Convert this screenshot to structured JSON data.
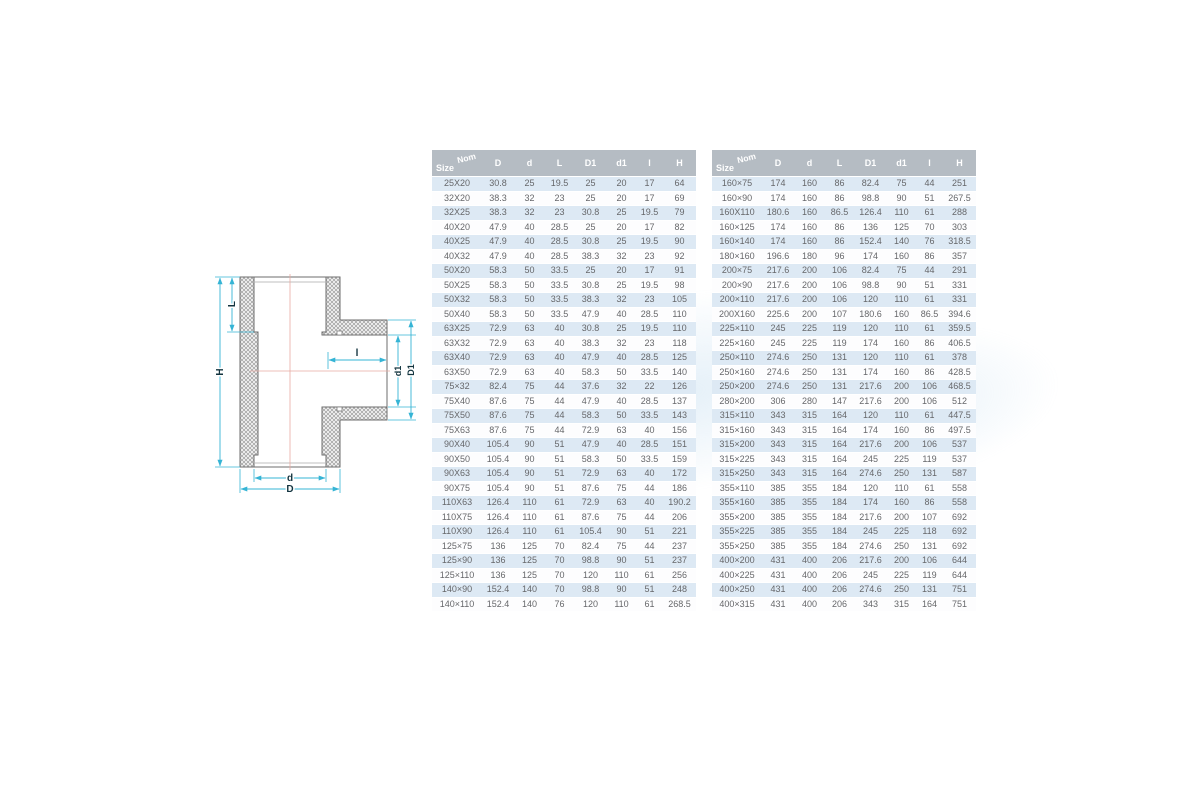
{
  "diagram": {
    "labels": {
      "H": "H",
      "L": "L",
      "l": "l",
      "d1": "d1",
      "D1": "D1",
      "d": "d",
      "D": "D"
    },
    "colors": {
      "dimension": "#35b4d5",
      "centerline": "#e8aaa2",
      "outline": "#6e6e6e",
      "hatch": "#8c8c8c",
      "label": "#13343f"
    }
  },
  "tables": {
    "corner": {
      "top": "Nom",
      "bottom": "Size"
    },
    "columns": [
      "D",
      "d",
      "L",
      "D1",
      "d1",
      "l",
      "H"
    ],
    "colors": {
      "header_bg": "#b5bcc3",
      "header_text": "#ffffff",
      "stripe": "#dde9f4",
      "row_text": "#66676a"
    },
    "left_rows": [
      [
        "25X20",
        "30.8",
        "25",
        "19.5",
        "25",
        "20",
        "17",
        "64"
      ],
      [
        "32X20",
        "38.3",
        "32",
        "23",
        "25",
        "20",
        "17",
        "69"
      ],
      [
        "32X25",
        "38.3",
        "32",
        "23",
        "30.8",
        "25",
        "19.5",
        "79"
      ],
      [
        "40X20",
        "47.9",
        "40",
        "28.5",
        "25",
        "20",
        "17",
        "82"
      ],
      [
        "40X25",
        "47.9",
        "40",
        "28.5",
        "30.8",
        "25",
        "19.5",
        "90"
      ],
      [
        "40X32",
        "47.9",
        "40",
        "28.5",
        "38.3",
        "32",
        "23",
        "92"
      ],
      [
        "50X20",
        "58.3",
        "50",
        "33.5",
        "25",
        "20",
        "17",
        "91"
      ],
      [
        "50X25",
        "58.3",
        "50",
        "33.5",
        "30.8",
        "25",
        "19.5",
        "98"
      ],
      [
        "50X32",
        "58.3",
        "50",
        "33.5",
        "38.3",
        "32",
        "23",
        "105"
      ],
      [
        "50X40",
        "58.3",
        "50",
        "33.5",
        "47.9",
        "40",
        "28.5",
        "110"
      ],
      [
        "63X25",
        "72.9",
        "63",
        "40",
        "30.8",
        "25",
        "19.5",
        "110"
      ],
      [
        "63X32",
        "72.9",
        "63",
        "40",
        "38.3",
        "32",
        "23",
        "118"
      ],
      [
        "63X40",
        "72.9",
        "63",
        "40",
        "47.9",
        "40",
        "28.5",
        "125"
      ],
      [
        "63X50",
        "72.9",
        "63",
        "40",
        "58.3",
        "50",
        "33.5",
        "140"
      ],
      [
        "75×32",
        "82.4",
        "75",
        "44",
        "37.6",
        "32",
        "22",
        "126"
      ],
      [
        "75X40",
        "87.6",
        "75",
        "44",
        "47.9",
        "40",
        "28.5",
        "137"
      ],
      [
        "75X50",
        "87.6",
        "75",
        "44",
        "58.3",
        "50",
        "33.5",
        "143"
      ],
      [
        "75X63",
        "87.6",
        "75",
        "44",
        "72.9",
        "63",
        "40",
        "156"
      ],
      [
        "90X40",
        "105.4",
        "90",
        "51",
        "47.9",
        "40",
        "28.5",
        "151"
      ],
      [
        "90X50",
        "105.4",
        "90",
        "51",
        "58.3",
        "50",
        "33.5",
        "159"
      ],
      [
        "90X63",
        "105.4",
        "90",
        "51",
        "72.9",
        "63",
        "40",
        "172"
      ],
      [
        "90X75",
        "105.4",
        "90",
        "51",
        "87.6",
        "75",
        "44",
        "186"
      ],
      [
        "110X63",
        "126.4",
        "110",
        "61",
        "72.9",
        "63",
        "40",
        "190.2"
      ],
      [
        "110X75",
        "126.4",
        "110",
        "61",
        "87.6",
        "75",
        "44",
        "206"
      ],
      [
        "110X90",
        "126.4",
        "110",
        "61",
        "105.4",
        "90",
        "51",
        "221"
      ],
      [
        "125×75",
        "136",
        "125",
        "70",
        "82.4",
        "75",
        "44",
        "237"
      ],
      [
        "125×90",
        "136",
        "125",
        "70",
        "98.8",
        "90",
        "51",
        "237"
      ],
      [
        "125×110",
        "136",
        "125",
        "70",
        "120",
        "110",
        "61",
        "256"
      ],
      [
        "140×90",
        "152.4",
        "140",
        "70",
        "98.8",
        "90",
        "51",
        "248"
      ],
      [
        "140×110",
        "152.4",
        "140",
        "76",
        "120",
        "110",
        "61",
        "268.5"
      ]
    ],
    "right_rows": [
      [
        "160×75",
        "174",
        "160",
        "86",
        "82.4",
        "75",
        "44",
        "251"
      ],
      [
        "160×90",
        "174",
        "160",
        "86",
        "98.8",
        "90",
        "51",
        "267.5"
      ],
      [
        "160X110",
        "180.6",
        "160",
        "86.5",
        "126.4",
        "110",
        "61",
        "288"
      ],
      [
        "160×125",
        "174",
        "160",
        "86",
        "136",
        "125",
        "70",
        "303"
      ],
      [
        "160×140",
        "174",
        "160",
        "86",
        "152.4",
        "140",
        "76",
        "318.5"
      ],
      [
        "180×160",
        "196.6",
        "180",
        "96",
        "174",
        "160",
        "86",
        "357"
      ],
      [
        "200×75",
        "217.6",
        "200",
        "106",
        "82.4",
        "75",
        "44",
        "291"
      ],
      [
        "200×90",
        "217.6",
        "200",
        "106",
        "98.8",
        "90",
        "51",
        "331"
      ],
      [
        "200×110",
        "217.6",
        "200",
        "106",
        "120",
        "110",
        "61",
        "331"
      ],
      [
        "200X160",
        "225.6",
        "200",
        "107",
        "180.6",
        "160",
        "86.5",
        "394.6"
      ],
      [
        "225×110",
        "245",
        "225",
        "119",
        "120",
        "110",
        "61",
        "359.5"
      ],
      [
        "225×160",
        "245",
        "225",
        "119",
        "174",
        "160",
        "86",
        "406.5"
      ],
      [
        "250×110",
        "274.6",
        "250",
        "131",
        "120",
        "110",
        "61",
        "378"
      ],
      [
        "250×160",
        "274.6",
        "250",
        "131",
        "174",
        "160",
        "86",
        "428.5"
      ],
      [
        "250×200",
        "274.6",
        "250",
        "131",
        "217.6",
        "200",
        "106",
        "468.5"
      ],
      [
        "280×200",
        "306",
        "280",
        "147",
        "217.6",
        "200",
        "106",
        "512"
      ],
      [
        "315×110",
        "343",
        "315",
        "164",
        "120",
        "110",
        "61",
        "447.5"
      ],
      [
        "315×160",
        "343",
        "315",
        "164",
        "174",
        "160",
        "86",
        "497.5"
      ],
      [
        "315×200",
        "343",
        "315",
        "164",
        "217.6",
        "200",
        "106",
        "537"
      ],
      [
        "315×225",
        "343",
        "315",
        "164",
        "245",
        "225",
        "119",
        "537"
      ],
      [
        "315×250",
        "343",
        "315",
        "164",
        "274.6",
        "250",
        "131",
        "587"
      ],
      [
        "355×110",
        "385",
        "355",
        "184",
        "120",
        "110",
        "61",
        "558"
      ],
      [
        "355×160",
        "385",
        "355",
        "184",
        "174",
        "160",
        "86",
        "558"
      ],
      [
        "355×200",
        "385",
        "355",
        "184",
        "217.6",
        "200",
        "107",
        "692"
      ],
      [
        "355×225",
        "385",
        "355",
        "184",
        "245",
        "225",
        "118",
        "692"
      ],
      [
        "355×250",
        "385",
        "355",
        "184",
        "274.6",
        "250",
        "131",
        "692"
      ],
      [
        "400×200",
        "431",
        "400",
        "206",
        "217.6",
        "200",
        "106",
        "644"
      ],
      [
        "400×225",
        "431",
        "400",
        "206",
        "245",
        "225",
        "119",
        "644"
      ],
      [
        "400×250",
        "431",
        "400",
        "206",
        "274.6",
        "250",
        "131",
        "751"
      ],
      [
        "400×315",
        "431",
        "400",
        "206",
        "343",
        "315",
        "164",
        "751"
      ]
    ]
  }
}
